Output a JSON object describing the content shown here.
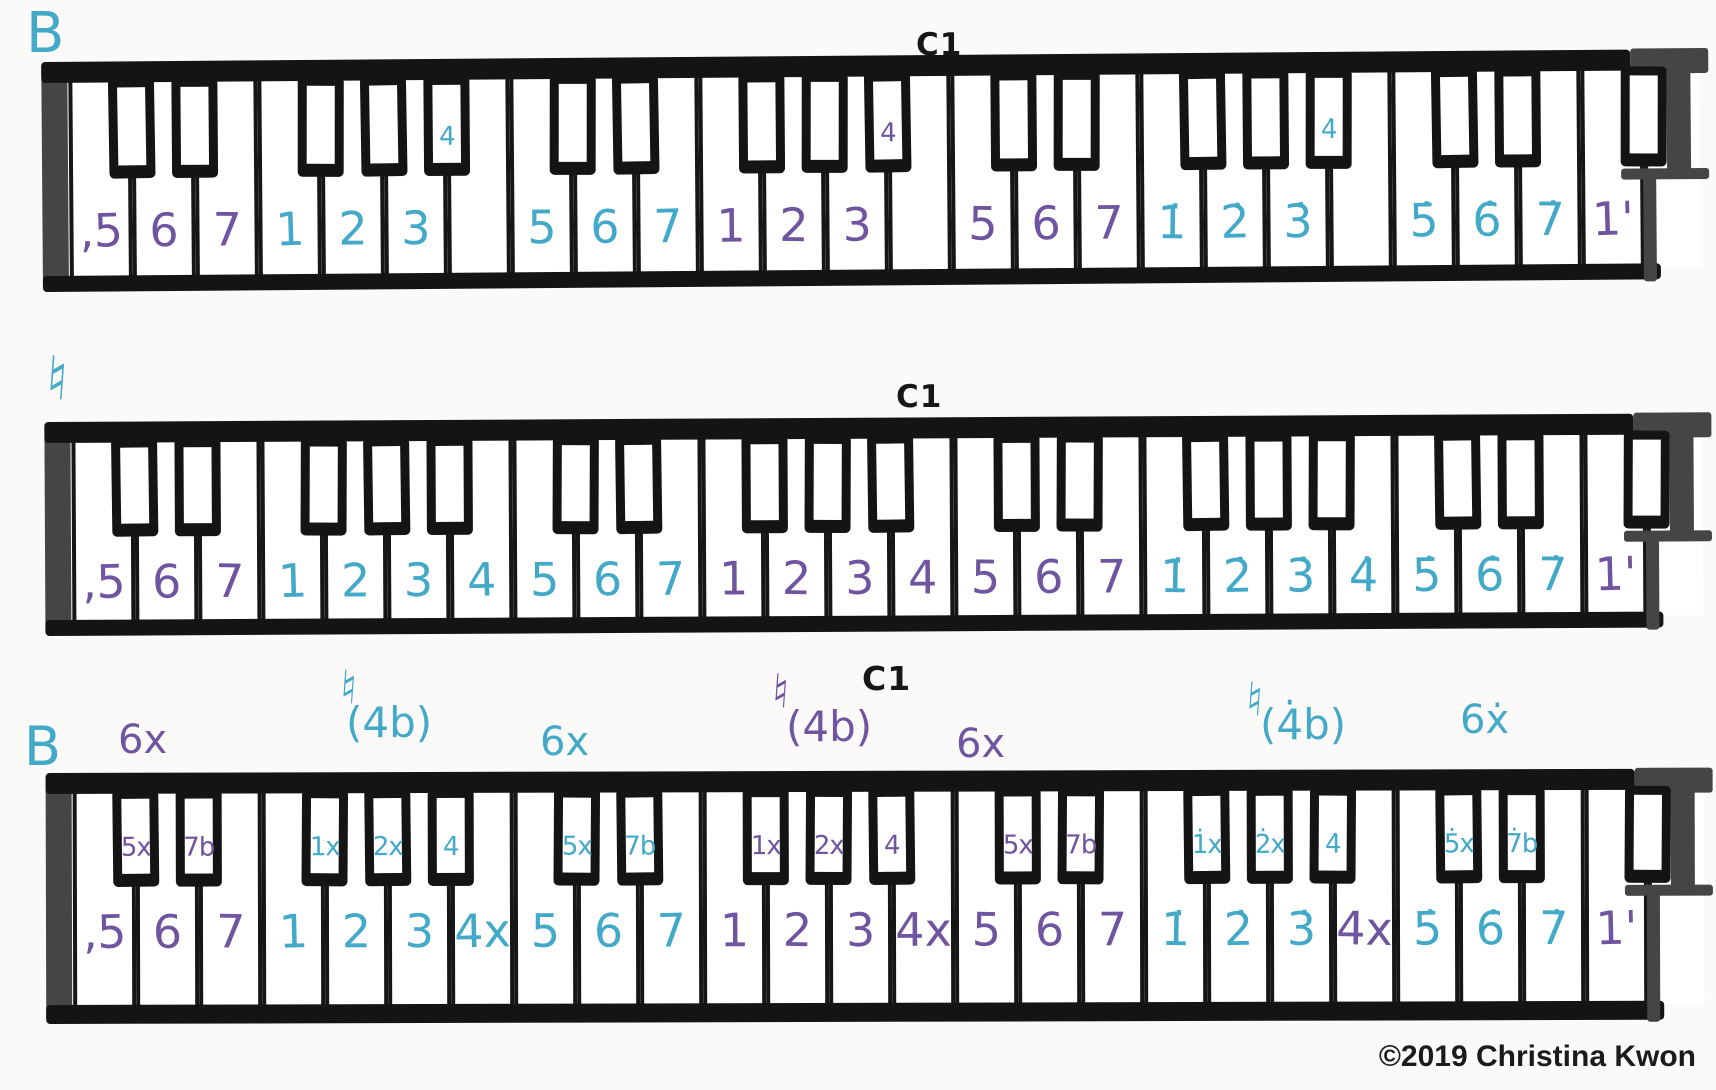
{
  "page": {
    "copyright": "©2019 Christina Kwon"
  },
  "colors": {
    "teal": "#43a9c9",
    "purple": "#6f55a0",
    "ink": "#171717",
    "grey": "#474747"
  },
  "keyboards": [
    {
      "name": "keyboard-flat-key",
      "annotations": [
        {
          "name": "key-flat-label",
          "text": "B",
          "color": "teal",
          "x": 26,
          "y": 6,
          "size": 56
        },
        {
          "name": "c1-label",
          "text": "C1",
          "color": "ink",
          "x": 916,
          "y": 30,
          "size": 31,
          "bold": true
        }
      ],
      "white_labels": [
        {
          "text": "‚5",
          "color": "purple"
        },
        {
          "text": "6",
          "color": "purple"
        },
        {
          "text": "7",
          "color": "purple"
        },
        {
          "text": "1",
          "color": "teal"
        },
        {
          "text": "2",
          "color": "teal"
        },
        {
          "text": "3",
          "color": "teal"
        },
        null,
        {
          "text": "5",
          "color": "teal"
        },
        {
          "text": "6",
          "color": "teal"
        },
        {
          "text": "7",
          "color": "teal"
        },
        {
          "text": "1",
          "color": "purple"
        },
        {
          "text": "2",
          "color": "purple"
        },
        {
          "text": "3",
          "color": "purple"
        },
        null,
        {
          "text": "5",
          "color": "purple"
        },
        {
          "text": "6",
          "color": "purple"
        },
        {
          "text": "7",
          "color": "purple"
        },
        {
          "text": "1̇",
          "color": "teal"
        },
        {
          "text": "2̇",
          "color": "teal"
        },
        {
          "text": "3̇",
          "color": "teal"
        },
        null,
        {
          "text": "5̇",
          "color": "teal"
        },
        {
          "text": "6̇",
          "color": "teal"
        },
        {
          "text": "7̇",
          "color": "teal"
        },
        {
          "text": "1'",
          "color": "purple"
        }
      ],
      "black_labels": {
        "5": {
          "text": "4",
          "color": "teal"
        },
        "12": {
          "text": "4",
          "color": "purple"
        },
        "19": {
          "text": "4̇",
          "color": "teal"
        }
      }
    },
    {
      "name": "keyboard-natural-key",
      "annotations": [
        {
          "name": "key-natural-label",
          "text": "♮",
          "color": "teal",
          "x": 46,
          "y": 348,
          "size": 62
        },
        {
          "name": "c1-label",
          "text": "C1",
          "color": "ink",
          "x": 896,
          "y": 382,
          "size": 31,
          "bold": true
        }
      ],
      "white_labels": [
        {
          "text": "‚5",
          "color": "purple"
        },
        {
          "text": "6",
          "color": "purple"
        },
        {
          "text": "7",
          "color": "purple"
        },
        {
          "text": "1",
          "color": "teal"
        },
        {
          "text": "2",
          "color": "teal"
        },
        {
          "text": "3",
          "color": "teal"
        },
        {
          "text": "4",
          "color": "teal"
        },
        {
          "text": "5",
          "color": "teal"
        },
        {
          "text": "6",
          "color": "teal"
        },
        {
          "text": "7",
          "color": "teal"
        },
        {
          "text": "1",
          "color": "purple"
        },
        {
          "text": "2",
          "color": "purple"
        },
        {
          "text": "3",
          "color": "purple"
        },
        {
          "text": "4",
          "color": "purple"
        },
        {
          "text": "5",
          "color": "purple"
        },
        {
          "text": "6",
          "color": "purple"
        },
        {
          "text": "7",
          "color": "purple"
        },
        {
          "text": "1̇",
          "color": "teal"
        },
        {
          "text": "2̇",
          "color": "teal"
        },
        {
          "text": "3̇",
          "color": "teal"
        },
        {
          "text": "4̇",
          "color": "teal"
        },
        {
          "text": "5̇",
          "color": "teal"
        },
        {
          "text": "6̇",
          "color": "teal"
        },
        {
          "text": "7̇",
          "color": "teal"
        },
        {
          "text": "1'",
          "color": "purple"
        }
      ],
      "black_labels": {}
    },
    {
      "name": "keyboard-flat-key-chromatic",
      "annotations": [
        {
          "name": "key-flat-label",
          "text": "B",
          "color": "teal",
          "x": 24,
          "y": 720,
          "size": 54
        },
        {
          "name": "alt-6-sharp-label",
          "text": "6x",
          "color": "purple",
          "x": 118,
          "y": 720,
          "size": 40
        },
        {
          "name": "natural-sign-label",
          "text": "♮",
          "color": "teal",
          "x": 340,
          "y": 664,
          "size": 48
        },
        {
          "name": "alt-4-flat-label",
          "text": "(4b)",
          "color": "teal",
          "x": 346,
          "y": 702,
          "size": 42
        },
        {
          "name": "alt-6-sharp-label",
          "text": "6x",
          "color": "teal",
          "x": 540,
          "y": 722,
          "size": 40
        },
        {
          "name": "natural-sign-label",
          "text": "♮",
          "color": "purple",
          "x": 772,
          "y": 668,
          "size": 48
        },
        {
          "name": "alt-4-flat-label",
          "text": "(4b)",
          "color": "purple",
          "x": 786,
          "y": 706,
          "size": 42
        },
        {
          "name": "c1-label",
          "text": "C1",
          "color": "ink",
          "x": 862,
          "y": 662,
          "size": 33,
          "bold": true
        },
        {
          "name": "alt-6-sharp-label",
          "text": "6x",
          "color": "purple",
          "x": 956,
          "y": 724,
          "size": 40
        },
        {
          "name": "natural-sign-label",
          "text": "♮",
          "color": "teal",
          "x": 1246,
          "y": 676,
          "size": 48
        },
        {
          "name": "alt-4-flat-label",
          "text": "(4̇b)",
          "color": "teal",
          "x": 1260,
          "y": 704,
          "size": 42
        },
        {
          "name": "alt-6-sharp-label",
          "text": "6ẋ",
          "color": "teal",
          "x": 1460,
          "y": 700,
          "size": 40
        }
      ],
      "white_labels": [
        {
          "text": "‚5",
          "color": "purple"
        },
        {
          "text": "6",
          "color": "purple"
        },
        {
          "text": "7",
          "color": "purple"
        },
        {
          "text": "1",
          "color": "teal"
        },
        {
          "text": "2",
          "color": "teal"
        },
        {
          "text": "3",
          "color": "teal"
        },
        {
          "text": "4x",
          "color": "teal"
        },
        {
          "text": "5",
          "color": "teal"
        },
        {
          "text": "6",
          "color": "teal"
        },
        {
          "text": "7",
          "color": "teal"
        },
        {
          "text": "1",
          "color": "purple"
        },
        {
          "text": "2",
          "color": "purple"
        },
        {
          "text": "3",
          "color": "purple"
        },
        {
          "text": "4x",
          "color": "purple"
        },
        {
          "text": "5",
          "color": "purple"
        },
        {
          "text": "6",
          "color": "purple"
        },
        {
          "text": "7",
          "color": "purple"
        },
        {
          "text": "1̇",
          "color": "teal"
        },
        {
          "text": "2̇",
          "color": "teal"
        },
        {
          "text": "3̇",
          "color": "teal"
        },
        {
          "text": "4x",
          "color": "purple"
        },
        {
          "text": "5̇",
          "color": "teal"
        },
        {
          "text": "6̇",
          "color": "teal"
        },
        {
          "text": "7̇",
          "color": "teal"
        },
        {
          "text": "1'",
          "color": "purple"
        }
      ],
      "black_labels": {
        "0": {
          "text": "5x",
          "color": "purple"
        },
        "1": {
          "text": "7b",
          "color": "purple"
        },
        "3": {
          "text": "1x",
          "color": "teal"
        },
        "4": {
          "text": "2x",
          "color": "teal"
        },
        "5": {
          "text": "4",
          "color": "teal"
        },
        "7": {
          "text": "5x",
          "color": "teal"
        },
        "8": {
          "text": "7b",
          "color": "teal"
        },
        "10": {
          "text": "1x",
          "color": "purple"
        },
        "11": {
          "text": "2x",
          "color": "purple"
        },
        "12": {
          "text": "4",
          "color": "purple"
        },
        "14": {
          "text": "5x",
          "color": "purple"
        },
        "15": {
          "text": "7b",
          "color": "purple"
        },
        "17": {
          "text": "1̇x",
          "color": "teal"
        },
        "18": {
          "text": "2̇x",
          "color": "teal"
        },
        "19": {
          "text": "4̇",
          "color": "teal"
        },
        "21": {
          "text": "5̇x",
          "color": "teal"
        },
        "22": {
          "text": "7̇b",
          "color": "teal"
        }
      }
    }
  ]
}
